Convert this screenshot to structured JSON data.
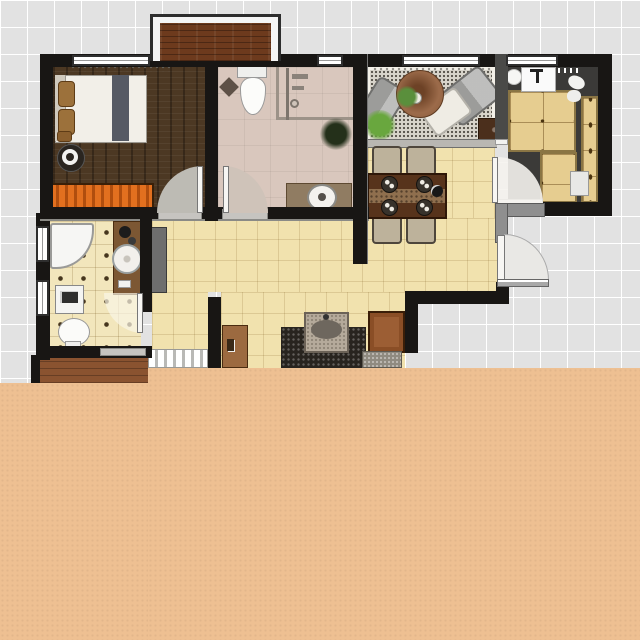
{
  "app": "floor-plan-viewer",
  "canvas": {
    "width": 640,
    "height": 640,
    "grid_cell_px": 27
  },
  "overlay": {
    "name": "peach-cover",
    "color": "#eec092",
    "covers": "bottom portion of image"
  },
  "palette": {
    "exterior_grid": "#e2e2e2",
    "grid_line": "#ffffff",
    "wall": "#181614",
    "peach_overlay": "#eec092",
    "bedroom_floor": "#4c3823",
    "bathroom_top_floor": "#d9c7bd",
    "living_floor": "#f3f0e8",
    "tile_floor": "#f1e2ae",
    "bathroom_left_tile": "#f2e6bc",
    "kitchen_floor": "#3b3a38",
    "cabinet_wood": "#e6cd90",
    "balcony_wood": "#6d3a1d",
    "entry_wood": "#8a5330",
    "dresser_orange": "#e2701f",
    "dining_table": "#57331b",
    "rug": "#d8d4cb",
    "granite": "#28241f"
  },
  "rooms": {
    "bedroom": {
      "name": "bedroom",
      "floor": "dark wood planks"
    },
    "bathroom_top": {
      "name": "bathroom-top",
      "floor": "beige stone"
    },
    "living_room": {
      "name": "living-room",
      "floor": "light with gray rug"
    },
    "kitchen": {
      "name": "kitchen",
      "floor": "charcoal"
    },
    "dining_area": {
      "name": "dining-area",
      "floor": "beige tile"
    },
    "hallway": {
      "name": "hallway",
      "floor": "beige tile"
    },
    "bathroom_left": {
      "name": "bathroom-left",
      "floor": "beige tile with diamond inlays"
    },
    "bar_nook": {
      "name": "bar-nook",
      "floor": "beige tile"
    },
    "balcony": {
      "name": "balcony-bay",
      "floor": "dark wood"
    },
    "entry": {
      "name": "entry-porch"
    }
  },
  "furniture": {
    "bed": {
      "name": "double-bed",
      "room": "bedroom"
    },
    "speaker": {
      "name": "round-speaker",
      "room": "bedroom"
    },
    "dresser": {
      "name": "orange-dresser",
      "room": "bedroom"
    },
    "toilet_top": {
      "name": "toilet",
      "room": "bathroom_top"
    },
    "shower": {
      "name": "shower-enclosure",
      "room": "bathroom_top"
    },
    "vanity_top": {
      "name": "vanity-with-round-sink",
      "room": "bathroom_top"
    },
    "plant_dark": {
      "name": "potted-plant",
      "room": "bathroom_top"
    },
    "sofa_left": {
      "name": "armchair-left",
      "room": "living_room"
    },
    "sofa_right": {
      "name": "armchair-right",
      "room": "living_room"
    },
    "chaise": {
      "name": "chaise-lounge",
      "room": "living_room"
    },
    "coffee_table": {
      "name": "round-coffee-table",
      "room": "living_room"
    },
    "plants_living": {
      "name": "green-plants",
      "room": "living_room"
    },
    "side_table": {
      "name": "side-table",
      "room": "living_room"
    },
    "dining_table": {
      "name": "dining-table",
      "room": "dining_area"
    },
    "dining_chairs": {
      "name": "dining-chair",
      "count": 4,
      "room": "dining_area"
    },
    "kitchen_sink": {
      "name": "kitchen-sink",
      "room": "kitchen"
    },
    "kitchen_counters": {
      "name": "wood-cabinets",
      "room": "kitchen"
    },
    "fridge": {
      "name": "appliance",
      "room": "kitchen"
    },
    "hall_cabinet": {
      "name": "hall-cabinet",
      "room": "hallway"
    },
    "corner_tub": {
      "name": "corner-bathtub",
      "room": "bathroom_left"
    },
    "washer": {
      "name": "washing-machine",
      "room": "bathroom_left"
    },
    "toilet_left": {
      "name": "toilet",
      "room": "bathroom_left"
    },
    "vanity_left": {
      "name": "vanity-strip-with-basin",
      "room": "bathroom_left"
    },
    "bar_counter": {
      "name": "granite-counter-with-sink",
      "room": "bar_nook"
    },
    "bar_chair": {
      "name": "chair",
      "room": "bar_nook"
    },
    "loose_door": {
      "name": "brown-door-leaf",
      "room": "bar_nook"
    },
    "stairs": {
      "name": "step-strip",
      "room": "hallway"
    }
  },
  "openings": {
    "bedroom_door": "swing door into bedroom",
    "bathroom_top_door": "swing door into bathroom",
    "bathroom_left_door": "swing door into left bathroom",
    "kitchen_door": "swing door into kitchen",
    "entry_door": "entry door swinging outward",
    "windows_top": 4,
    "windows_left": 2
  }
}
